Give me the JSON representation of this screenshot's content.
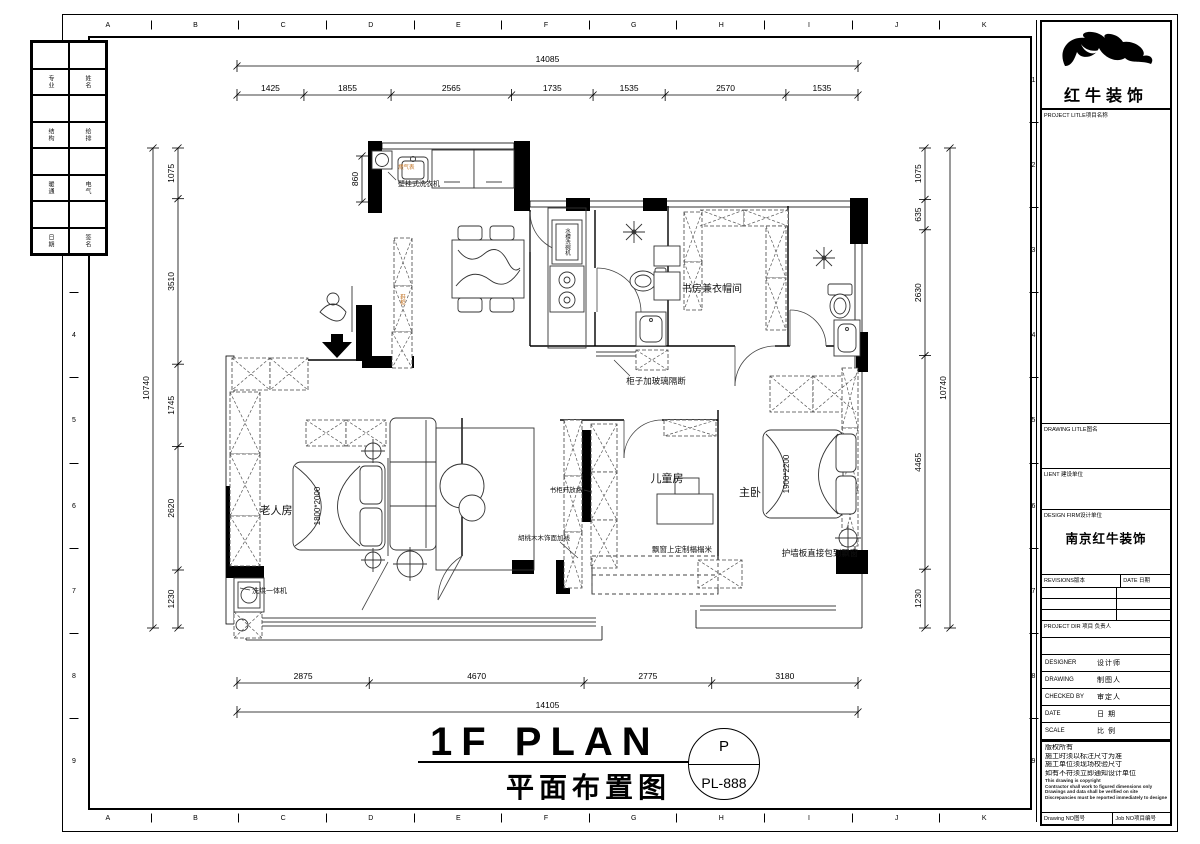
{
  "sheet": {
    "grid_letters": [
      "A",
      "B",
      "C",
      "D",
      "E",
      "F",
      "G",
      "H",
      "I",
      "J",
      "K"
    ],
    "grid_numbers": [
      "1",
      "2",
      "3",
      "4",
      "5",
      "6",
      "7",
      "8",
      "9"
    ]
  },
  "sign_strip": {
    "cells": [
      "专业",
      "姓名",
      "结构",
      "给排",
      "暖通",
      "电气",
      "日期",
      "签名"
    ]
  },
  "title_block": {
    "company": "红牛装饰",
    "project_label": "PROJECT LITLE项目名称",
    "drawing_label": "DRAWING LITLE图名",
    "client_label": "LIENT 建设单位",
    "firm_label": "DESIGN FIRM设计单位",
    "firm_name": "南京红牛装饰",
    "revisions_label": "REVISIONS版本",
    "rev_date_label": "DATE 日期",
    "project_dir_label": "PROJECT DIR 项目 负责人",
    "rows": [
      {
        "en": "DESIGNER",
        "cn": "设计师"
      },
      {
        "en": "DRAWING",
        "cn": "制图人"
      },
      {
        "en": "CHECKED BY",
        "cn": "审定人"
      },
      {
        "en": "DATE",
        "cn": "日 期"
      },
      {
        "en": "SCALE",
        "cn": "比 例"
      }
    ],
    "notes_cn": [
      "版权所有",
      "施工时须以标注尺寸为准",
      "施工单位须现场校验尺寸",
      "如有不符须立即通知设计单位"
    ],
    "notes_en": [
      "This drawing is copyright",
      "Contractor shall work to figured dimensions only",
      "Drawings and data shall be verified on site",
      "Discrepancies must be reported immediately to designer"
    ],
    "drawing_no_label": "Drawing NO图号",
    "job_no_label": "Job NO项目编号"
  },
  "plan": {
    "room_elder": "老人房",
    "room_child": "儿童房",
    "room_master": "主卧",
    "room_study": "书房兼衣帽间",
    "ann_washer": "壁挂式洗衣机",
    "ann_cabinet_glass": "柜子加玻璃隔断",
    "ann_wallpanel": "护墙板直接包到飘窗",
    "ann_tatami": "飘窗上定制榻榻米",
    "ann_bookshelf": "书柜开放格",
    "ann_walnut": "胡桃木木饰面加线",
    "ann_washdry": "洗烘一体机",
    "ann_sink": "水槽洗碗机",
    "ann_shoe": "鞋柜",
    "ann_gas": "燃气表",
    "bed_elder": "1800*2000",
    "bed_master": "1900*2200"
  },
  "dims": {
    "top_total": [
      "14085"
    ],
    "top_segments": [
      "1425",
      "1855",
      "2565",
      "1735",
      "1535",
      "2570",
      "1535"
    ],
    "bottom_segments": [
      "2875",
      "4670",
      "2775",
      "3180"
    ],
    "bottom_total": [
      "14105"
    ],
    "left_segments": [
      "1075",
      "3510",
      "1745",
      "2620",
      "1230"
    ],
    "left_total": [
      "10740"
    ],
    "right_segments": [
      "1075",
      "635",
      "2630",
      "4465",
      "1230"
    ],
    "right_total": [
      "10740"
    ],
    "dim_860": [
      "860"
    ]
  },
  "footer": {
    "title_en": "1F PLAN",
    "title_cn": "平面布置图",
    "circle_letter": "P",
    "sheet_no": "PL-888"
  }
}
